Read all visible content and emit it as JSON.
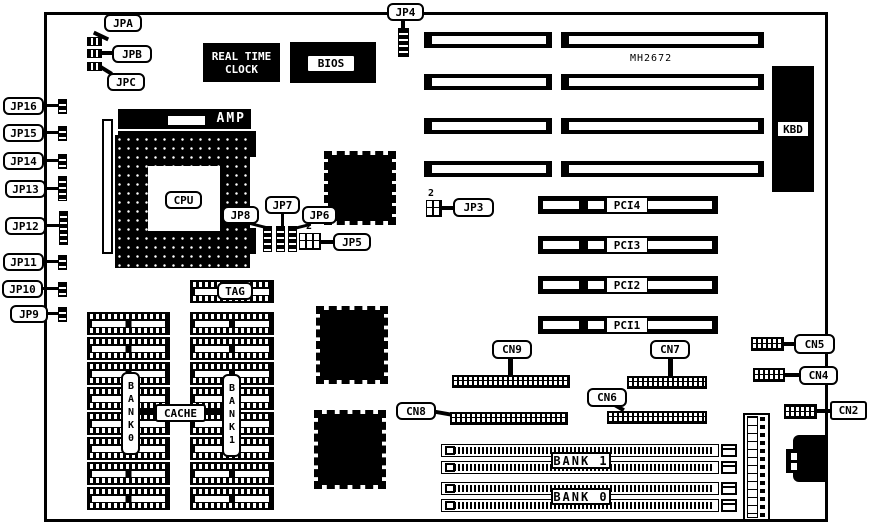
{
  "board": {
    "model": "MH2672"
  },
  "jumpers": {
    "jpa": "JPA",
    "jpb": "JPB",
    "jpc": "JPC",
    "jp3": "JP3",
    "jp4": "JP4",
    "jp5": "JP5",
    "jp6": "JP6",
    "jp7": "JP7",
    "jp8": "JP8",
    "jp9": "JP9",
    "jp10": "JP10",
    "jp11": "JP11",
    "jp12": "JP12",
    "jp13": "JP13",
    "jp14": "JP14",
    "jp15": "JP15",
    "jp16": "JP16",
    "jp5_pin2": "2",
    "jp3_pin2": "2"
  },
  "connectors": {
    "cn2": "CN2",
    "cn4": "CN4",
    "cn5": "CN5",
    "cn6": "CN6",
    "cn7": "CN7",
    "cn8": "CN8",
    "cn9": "CN9",
    "kbd": "KBD"
  },
  "slots": {
    "pci1": "PCI1",
    "pci2": "PCI2",
    "pci3": "PCI3",
    "pci4": "PCI4"
  },
  "memory": {
    "cache": "CACHE",
    "tag": "TAG",
    "bank0_col": "BANK0",
    "bank1_col": "BANK1",
    "simm_bank1": "BANK 1",
    "simm_bank0": "BANK 0"
  },
  "chips": {
    "cpu": "CPU",
    "socket_brand": "AMP",
    "bios": "BIOS",
    "rtc_line1": "REAL TIME",
    "rtc_line2": "CLOCK"
  },
  "colors": {
    "ink": "#000000",
    "paper": "#ffffff"
  }
}
